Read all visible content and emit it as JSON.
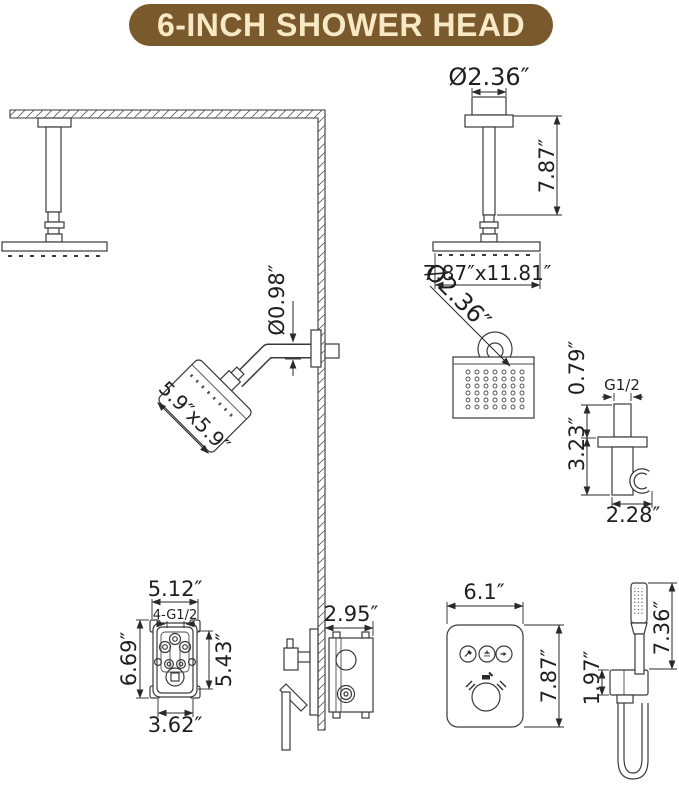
{
  "title_banner": {
    "text": "6-INCH SHOWER HEAD",
    "background": "#7a5a2c",
    "text_color": "#f7e9c5"
  },
  "drawing": {
    "line_color": "#3a3a3a",
    "ceiling_shower_detail": {
      "flange_diameter": "Ø2.36″",
      "arm_length": "7.87″",
      "head_size": "7.87″x11.81″"
    },
    "head_bottom_view": {
      "connector_diameter": "Ø2.36″"
    },
    "wall_shower": {
      "arm_diameter": "Ø0.98″",
      "head_size": "5.9″x5.9″"
    },
    "hand_shower_holder": {
      "inlet_height": "0.79″",
      "thread_size": "G1/2",
      "body_height": "3.23″",
      "depth": "2.28″"
    },
    "rough_in_valve": {
      "top_width": "5.12″",
      "thread_ports": "4-G1/2",
      "overall_height": "6.69″",
      "body_height": "5.43″",
      "bottom_width": "3.62″"
    },
    "valve_side_view": {
      "depth": "2.95″"
    },
    "trim_plate": {
      "width": "6.1″",
      "height": "7.87″"
    },
    "hand_shower": {
      "wand_length": "7.36″",
      "bracket_height": "1.97″"
    }
  }
}
